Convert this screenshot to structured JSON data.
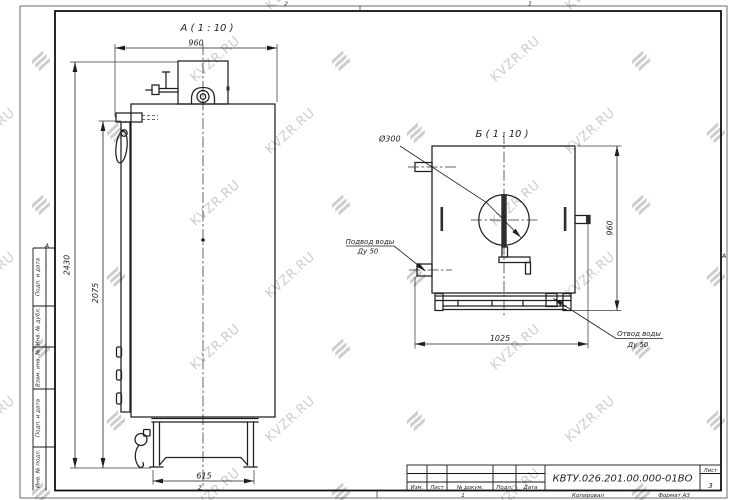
{
  "watermark": {
    "text": "KVZR.RU"
  },
  "frame": {
    "zone_top_left": "2",
    "zone_top_right": "1",
    "zone_bottom_left": "2",
    "zone_left_letter": "А",
    "zone_right_letter": "А"
  },
  "margin_labels": [
    "Подп. и дата",
    "Инв. № дубл.",
    "Взам. инв. №",
    "Подп. и дата",
    "Инв. № подл."
  ],
  "views": {
    "a": {
      "caption": "А ( 1 : 10 )",
      "dim_width_top": "960",
      "dim_height_total": "2430",
      "dim_height_body": "2075",
      "dim_base_width": "615"
    },
    "b": {
      "caption": "Б ( 1 : 10 )",
      "flue_diameter": "Ø300",
      "dim_height_right": "960",
      "dim_width_bottom": "1025",
      "inlet": {
        "line1": "Подвод воды",
        "line2": "Ду 50"
      },
      "outlet": {
        "line1": "Отвод воды",
        "line2": "Ду 50"
      }
    }
  },
  "title_block": {
    "designation": "КВТУ.026.201.00.000-01ВО",
    "columns": [
      "Изм.",
      "Лист",
      "№ докум.",
      "Подп.",
      "Дата"
    ],
    "sheet_label": "Лист",
    "sheet_number": "3",
    "footer": {
      "zone": "1",
      "copied": "Копировал",
      "format": "Формат А3"
    }
  }
}
